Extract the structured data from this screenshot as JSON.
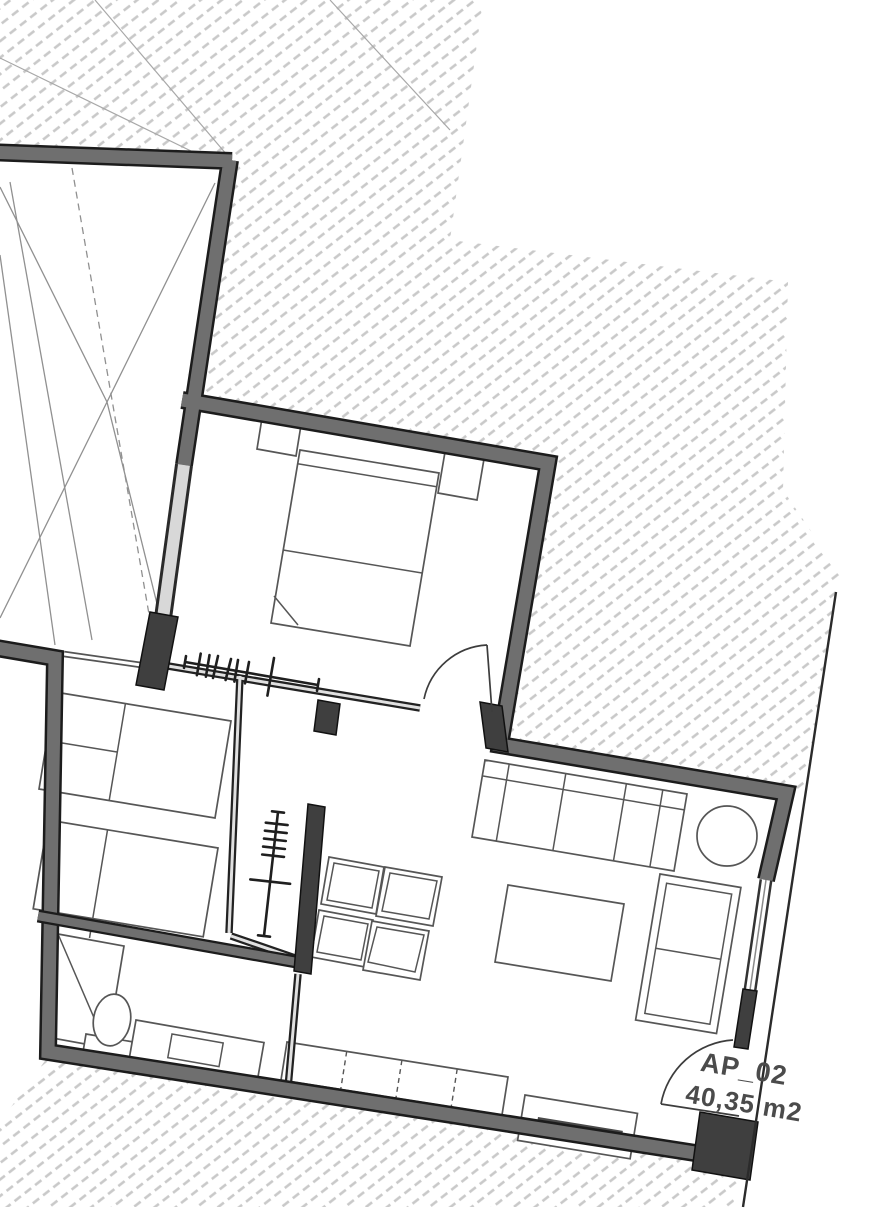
{
  "plan": {
    "unit_label": "AP_02",
    "unit_area": "40,35 m2",
    "colors": {
      "background": "#ffffff",
      "wall_fill": "#6f6f6f",
      "wall_edge": "#1c1c1c",
      "dark_block": "#3f3f3f",
      "partition": "#222222",
      "window_fill": "#d8d8d8",
      "hatch": "#c9c9c9",
      "furniture_stroke": "#565656",
      "boundary_line": "#2b2b2b",
      "label_color": "#4b4b4b"
    },
    "symbols": [
      "double-bed-icon",
      "nightstand-icon",
      "single-bed-icon",
      "clothes-rack-icon",
      "sofa-icon",
      "round-table-icon",
      "armchair-icon",
      "coffee-table-icon",
      "dining-chair-icon",
      "kitchen-counter-icon",
      "sideboard-icon",
      "toilet-icon",
      "shower-icon",
      "vanity-sink-icon",
      "door-swing-icon"
    ]
  }
}
